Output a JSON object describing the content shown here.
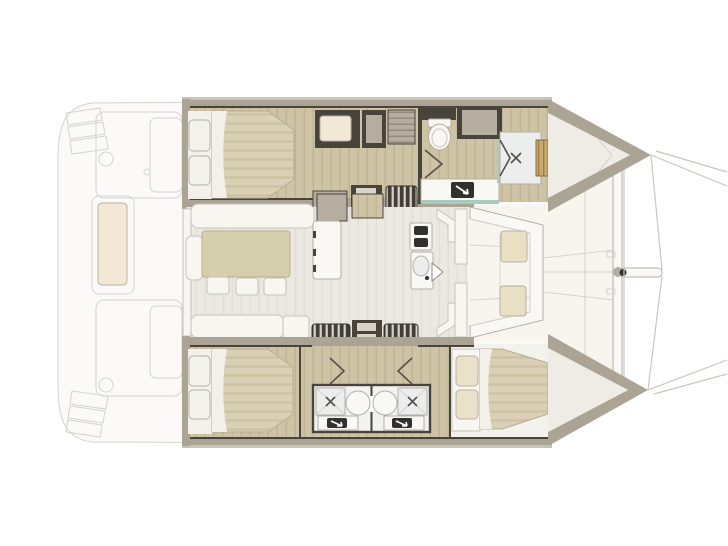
{
  "plan": {
    "vessel": "sailing-catamaran",
    "view": "top-down-interior-layout",
    "double_berths": 3,
    "bathrooms": 3,
    "toilets_visible": 1,
    "shower_drain_marks": 3,
    "round_basins_visible": 2,
    "vanity_sinks_visible": 3,
    "companionway_stairs": 3,
    "saloon": {
      "dinette_stools": 3,
      "u_sofa": 1,
      "aft_bench": 1,
      "galley_burner_units": 2
    },
    "forward_cockpit_cushions": 2,
    "aft_cockpit_cushions": 1,
    "bow_trampoline_lines": 2
  },
  "colors": {
    "bg": "#ffffff",
    "ghost_fill": "#fbfaf8",
    "ghost_line": "#d6d3ce",
    "deck_cream": "#f8f5ee",
    "hull_band": "#aba394",
    "hull_band_light": "#c9c3b7",
    "wall_dark": "#48443c",
    "wood": "#cfc3a6",
    "wood_grain": "#bdb091",
    "salon_floor": "#ebe8e1",
    "salon_grain": "#dfdbd2",
    "mattress": "#d9d0b5",
    "mattress_stripe": "#cdc3a4",
    "sheet_white": "#f2f0e9",
    "pillow_white": "#f4f2ec",
    "pillow_beige": "#eae2c8",
    "pillow_border": "#b5b0a4",
    "sofa_white": "#f7f6f1",
    "sofa_line": "#c7c3ba",
    "table_khaki": "#d6cfae",
    "table_line": "#b9b08c",
    "fixture_white": "#f9f8f5",
    "fixture_line": "#b3afa6",
    "shower_floor": "#eceded",
    "mark_dark": "#55514a",
    "teak": "#c9a96f",
    "teak_line": "#9a7a45",
    "steps_dark": "#433f38",
    "steps_rung": "#d8d4cb",
    "cabinet_gray": "#b4ada0",
    "cabinet_line": "#8e8779",
    "sink_dark": "#33312d",
    "teal_glass": "#a8cbbd",
    "cushion_cream": "#f2e8d5",
    "cushion_beige": "#e9e0c4",
    "rig_line": "#c9c6c0"
  }
}
